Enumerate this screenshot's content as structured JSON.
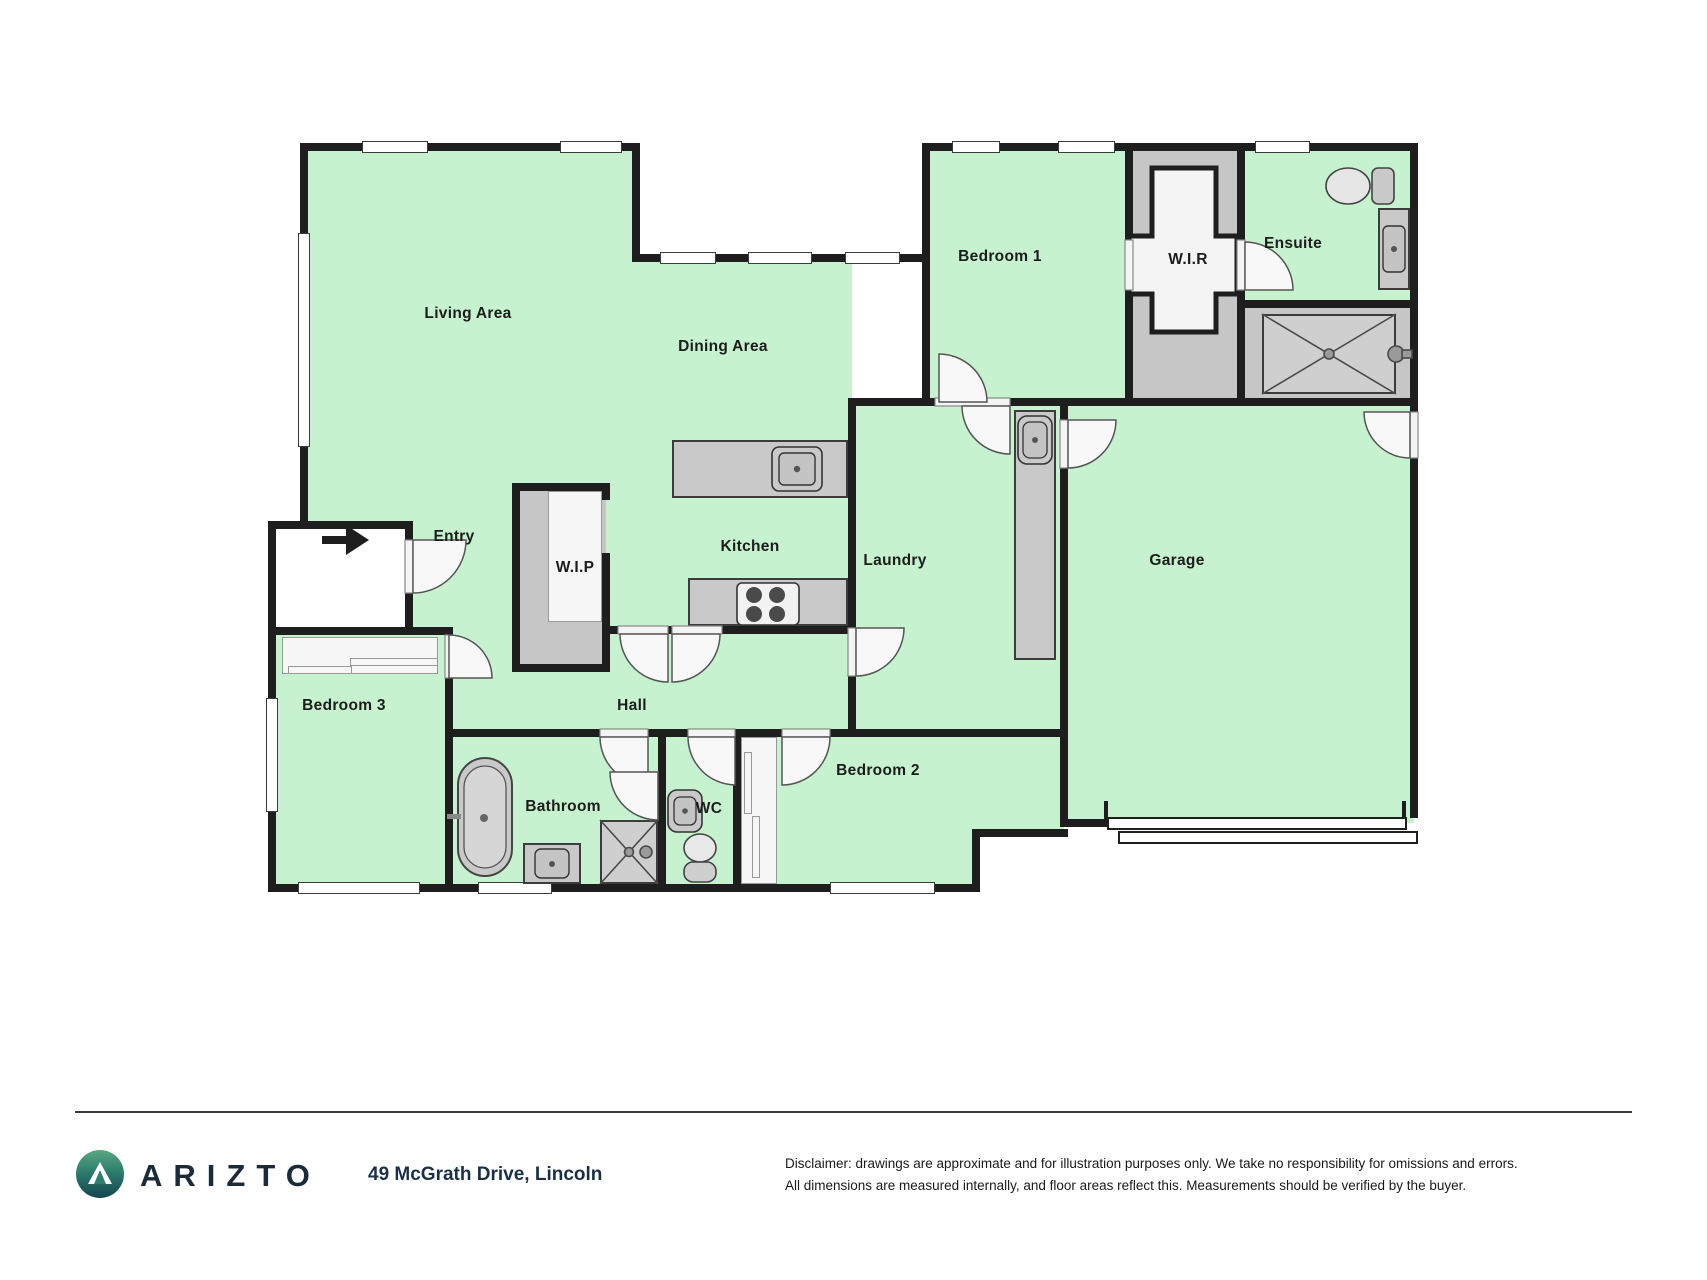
{
  "plan": {
    "rooms": [
      {
        "label": "Living Area"
      },
      {
        "label": "Dining Area"
      },
      {
        "label": "Bedroom 1"
      },
      {
        "label": "W.I.R"
      },
      {
        "label": "Ensuite"
      },
      {
        "label": "Garage"
      },
      {
        "label": "Kitchen"
      },
      {
        "label": "Laundry"
      },
      {
        "label": "Entry"
      },
      {
        "label": "W.I.P"
      },
      {
        "label": "Hall"
      },
      {
        "label": "Bedroom 3"
      },
      {
        "label": "Bedroom 2"
      },
      {
        "label": "Bathroom"
      },
      {
        "label": "WC"
      }
    ],
    "icons": {
      "entry_arrow": "right-arrow marking front entrance",
      "fixtures": [
        "bathtub",
        "toilet",
        "sink",
        "stove",
        "shower"
      ]
    },
    "colors": {
      "room_fill": "#c7f2cf",
      "wall": "#1e1e1e",
      "fixture_gray": "#c9c9c9"
    }
  },
  "footer": {
    "brand": "ARIZTO",
    "address": "49 McGrath Drive, Lincoln",
    "disclaimer_line1": "Disclaimer: drawings are approximate and for illustration purposes only. We take no responsibility for omissions and errors.",
    "disclaimer_line2": "All dimensions are measured internally, and floor areas reflect this. Measurements should be verified by the buyer.",
    "brand_color": "#1c2b3a",
    "logo_teal": "#2e7d6e"
  }
}
